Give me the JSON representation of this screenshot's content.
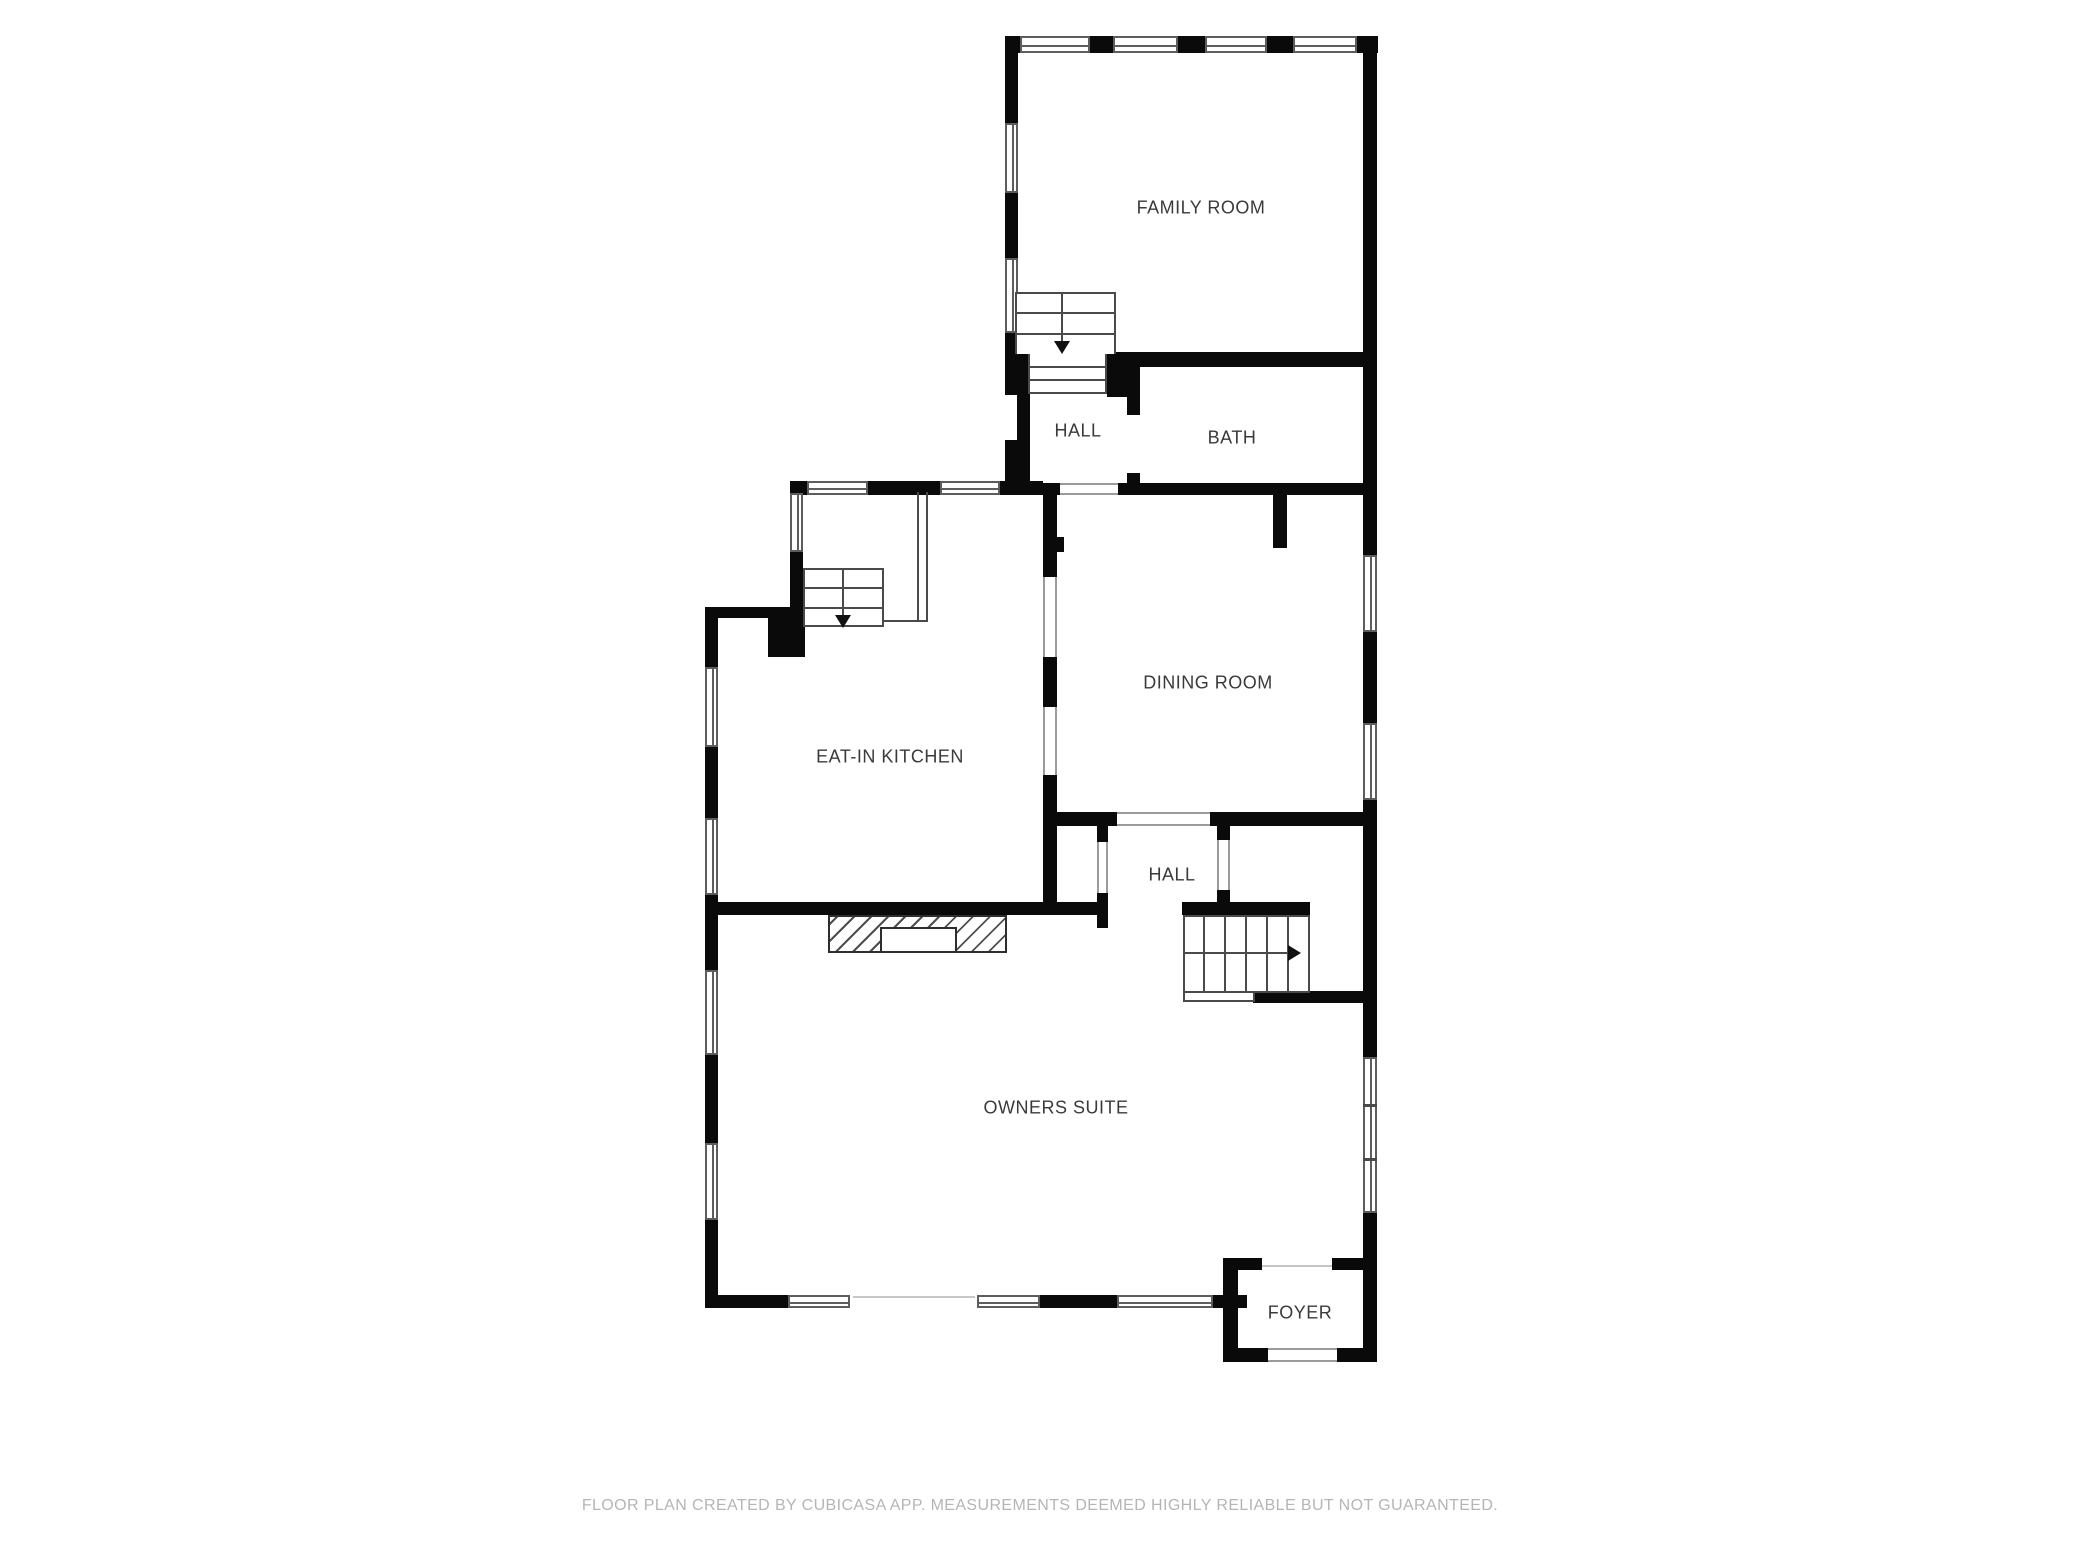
{
  "floor_plan": {
    "rooms": [
      {
        "label": "FAMILY ROOM"
      },
      {
        "label": "HALL"
      },
      {
        "label": "BATH"
      },
      {
        "label": "DINING ROOM"
      },
      {
        "label": "EAT-IN KITCHEN"
      },
      {
        "label": "HALL"
      },
      {
        "label": "OWNERS SUITE"
      },
      {
        "label": "FOYER"
      }
    ],
    "colors": {
      "wall": "#0a0a0a",
      "room_label": "#3a3a3a",
      "stair_line": "#4a4a4a",
      "footer_text": "#b5b5b5",
      "background": "#ffffff"
    },
    "icons": {
      "upper_stairs": "arrow-down-icon",
      "kitchen_stairs": "arrow-down-icon",
      "lower_stairs": "arrow-right-icon"
    }
  },
  "footer": {
    "disclaimer": "FLOOR PLAN CREATED BY CUBICASA APP. MEASUREMENTS DEEMED HIGHLY RELIABLE BUT NOT GUARANTEED."
  }
}
